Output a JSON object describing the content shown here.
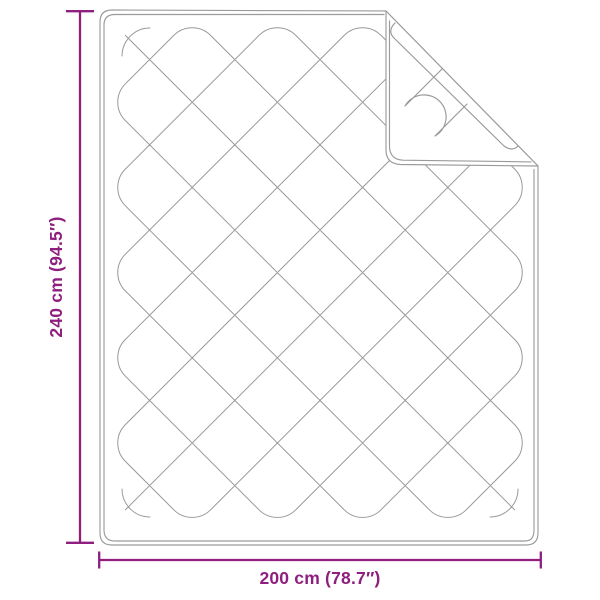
{
  "diagram": {
    "labels": {
      "height": "240 cm (94.5″)",
      "width": "200 cm (78.7″)"
    },
    "dimensions": {
      "height_cm": 240,
      "height_in": 94.5,
      "width_cm": 200,
      "width_in": 78.7
    },
    "colors": {
      "dimension": "#8E1F7E",
      "outline": "#9B9B9B",
      "quilt_line": "#999999",
      "fabric": "#FFFFFF",
      "background": "#FFFFFF"
    }
  }
}
